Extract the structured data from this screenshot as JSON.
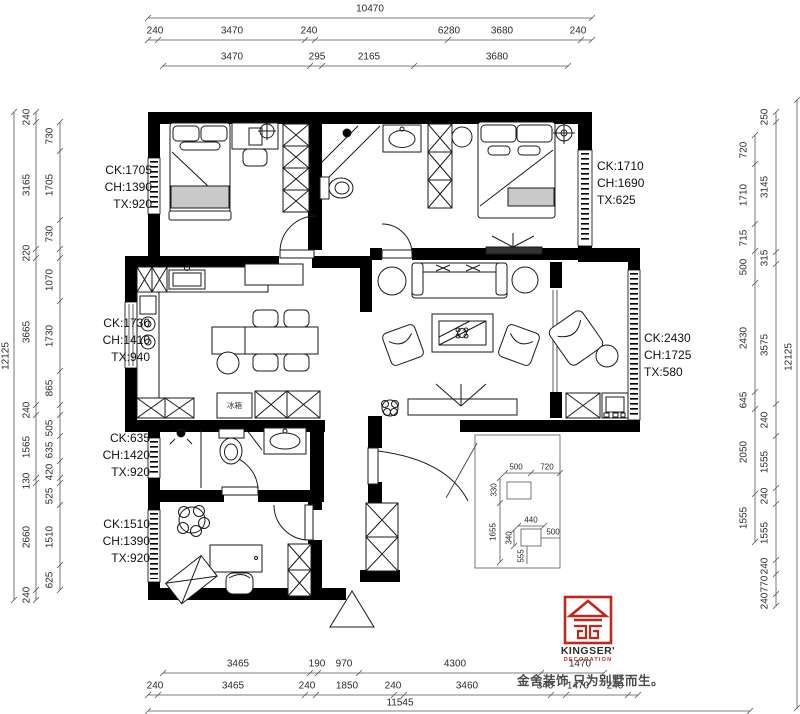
{
  "dims": {
    "top": {
      "overall": "10470",
      "row2": [
        "240",
        "3470",
        "240",
        "6280",
        "3680",
        "240"
      ],
      "row3": [
        "3470",
        "295",
        "2165",
        "3680"
      ]
    },
    "bottom": {
      "row1": [
        "3465",
        "190",
        "970",
        "4300",
        "1470"
      ],
      "row2": [
        "240",
        "3465",
        "240",
        "1850",
        "240",
        "3460",
        "340",
        "1470",
        "240"
      ],
      "overall": "11545"
    },
    "left": {
      "overall": "12125",
      "outer": [
        "240",
        "3165",
        "220",
        "3665",
        "240",
        "1565",
        "130",
        "2660",
        "240"
      ],
      "inner": [
        "730",
        "1705",
        "730",
        "1070",
        "1730",
        "865",
        "505",
        "635",
        "420",
        "525",
        "1510",
        "625"
      ]
    },
    "right": {
      "overall": "12125",
      "outer": [
        "250",
        "3145",
        "315",
        "3575",
        "240",
        "1555",
        "240",
        "1555",
        "240",
        "770",
        "240"
      ],
      "inner": [
        "720",
        "1710",
        "715",
        "500",
        "2430",
        "645",
        "2050",
        "1555"
      ]
    },
    "inset": {
      "w1": "500",
      "w2": "720",
      "h1": "330",
      "h2": "1655",
      "bw": "440",
      "bh": "340",
      "br": "500",
      "bb": "555"
    }
  },
  "windows": {
    "bed1": "CK:1705\nCH:1390\nTX:920",
    "kitchen": "CK:1730\nCH:1410\nTX:940",
    "bath2": "CK:635\nCH:1420\nTX:920",
    "bed2": "CK:1510\nCH:1390\nTX:920",
    "master": "CK:1710\nCH:1690\nTX:625",
    "balcony": "CK:2430\nCH:1725\nTX:580"
  },
  "appliances": {
    "fridge": "冰箱"
  },
  "brand": {
    "name": "KINGSER'",
    "sub": "DECORATION",
    "slogan": "金舍装饰 只为别墅而生。"
  },
  "colors": {
    "wall": "#000000",
    "accent_red": "#c2271d",
    "dim_text": "#2b2b2b"
  }
}
